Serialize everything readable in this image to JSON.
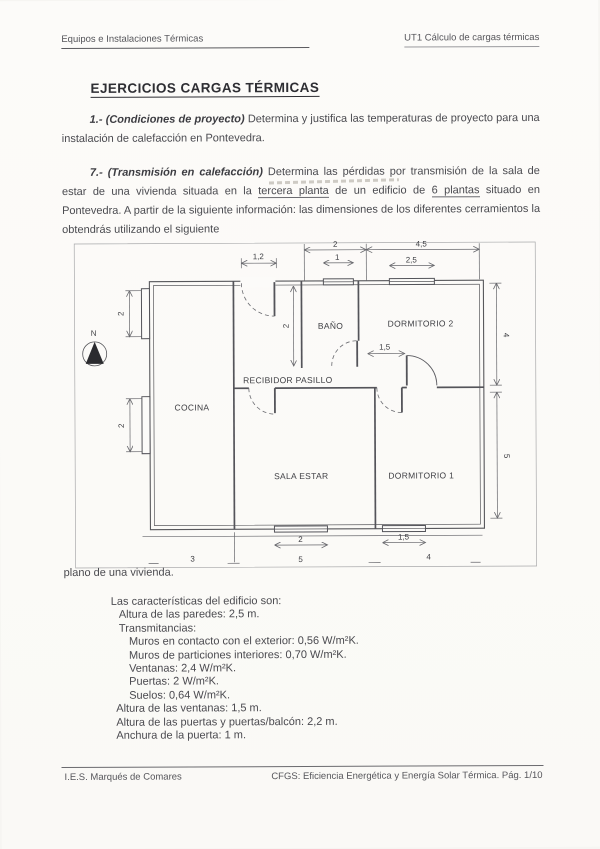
{
  "header": {
    "left": "Equipos e Instalaciones Térmicas",
    "right": "UT1 Cálculo de cargas térmicas"
  },
  "title": "EJERCICIOS CARGAS TÉRMICAS",
  "exercise1": {
    "number": "1.-",
    "name": "(Condiciones de proyecto)",
    "text": "Determina y justifica las temperaturas de proyecto para una instalación de calefacción en Pontevedra."
  },
  "exercise7": {
    "number": "7.-",
    "name": "(Transmisión en calefacción)",
    "seg1": "Determina las pérdidas por transmisión de la sala de estar de una vivienda situada en la ",
    "u1": "tercera planta",
    "seg2": " de un edificio de ",
    "u2": "6 plantas",
    "seg3": " situado en Pontevedra. A partir de la siguiente información: las dimensiones de los diferentes cerramientos la obtendrás utilizando el siguiente"
  },
  "figure": {
    "caption": "plano de una vivienda.",
    "north": "N",
    "rooms": {
      "cocina": "COCINA",
      "bano": "BAÑO",
      "dormitorio2": "DORMITORIO 2",
      "recibidor": "RECIBIDOR PASILLO",
      "sala": "SALA ESTAR",
      "dormitorio1": "DORMITORIO 1"
    },
    "dims": {
      "entrance_door": "1,2",
      "top_window_span": "2",
      "top_window": "1",
      "top_right_span": "4,5",
      "top_right_window": "2,5",
      "left_window_top": "2",
      "left_window_bottom": "2",
      "hall_depth": "2",
      "right_upper": "4",
      "right_lower": "5",
      "dorm2_door": "1,5",
      "sala_window": "2",
      "dorm1_window": "1,5",
      "width_cocina": "3",
      "width_sala": "5",
      "width_dorm1": "4"
    }
  },
  "characteristics": {
    "intro": "Las características del edificio son:",
    "lines": [
      "Altura de las paredes: 2,5 m.",
      "Transmitancias:",
      "Muros en contacto con el exterior: 0,56 W/m²K.",
      "Muros de particiones interiores: 0,70 W/m²K.",
      "Ventanas: 2,4 W/m²K.",
      "Puertas: 2 W/m²K.",
      "Suelos: 0,64 W/m²K.",
      "Altura de las ventanas: 1,5 m.",
      "Altura de las puertas y puertas/balcón: 2,2 m.",
      "Anchura de la puerta: 1 m."
    ]
  },
  "footer": {
    "left": "I.E.S. Marqués de Comares",
    "right": "CFGS: Eficiencia Energética y Energía Solar Térmica. Pág. 1/10"
  }
}
